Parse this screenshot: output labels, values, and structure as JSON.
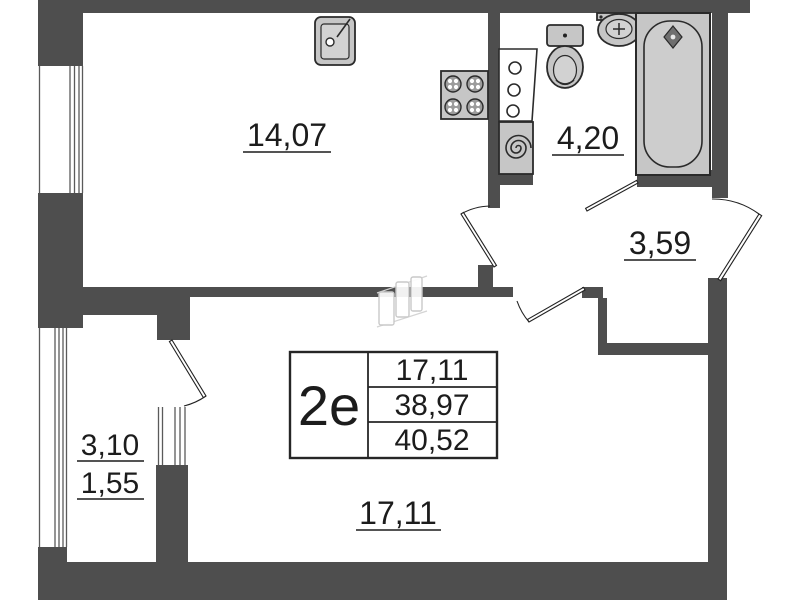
{
  "plan": {
    "unit": {
      "label": "2e"
    },
    "info_table": {
      "rows": [
        {
          "value": "17,11"
        },
        {
          "value": "38,97"
        },
        {
          "value": "40,52"
        }
      ]
    },
    "rooms": {
      "kitchen": {
        "area": "14,07"
      },
      "bathroom": {
        "area": "4,20"
      },
      "hall": {
        "area": "3,59"
      },
      "living_room": {
        "area": "17,11"
      },
      "balcony": {
        "area_total": "3,10",
        "area_counted": "1,55"
      }
    },
    "fixtures": {
      "kitchen_sink": "kitchen-sink-icon",
      "stove": "stove-4-burner-icon",
      "cabinet": "cabinet-icon",
      "washing_machine": "washing-machine-icon",
      "toilet": "toilet-icon",
      "washbasin": "washbasin-icon",
      "bathtub": "bathtub-icon",
      "sliding_door": "sliding-door-icon"
    },
    "colors": {
      "wall": "#4e4e4e",
      "fixture_fill": "#c6c6c6",
      "outline": "#2b2b2b",
      "label": "#1c1c1c",
      "door_icon": "#c9c9c9"
    }
  }
}
